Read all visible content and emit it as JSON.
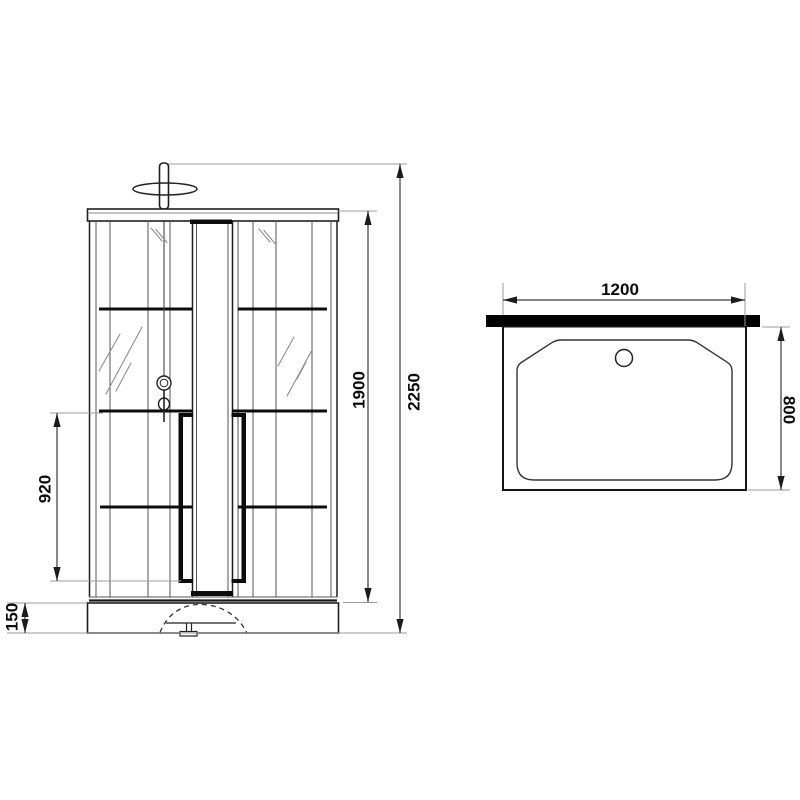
{
  "drawing": {
    "front_view": {
      "dim_total_height": "2250",
      "dim_cabin_height": "1900",
      "dim_door_opening_height": "920",
      "dim_tray_height": "150"
    },
    "plan_view": {
      "dim_width": "1200",
      "dim_depth": "800"
    },
    "colors": {
      "background": "#ffffff",
      "outline": "#1f1f1f",
      "thin_line": "#565656",
      "extension_line": "#9b9b9b",
      "solid_fill": "#0c0c0c"
    }
  }
}
